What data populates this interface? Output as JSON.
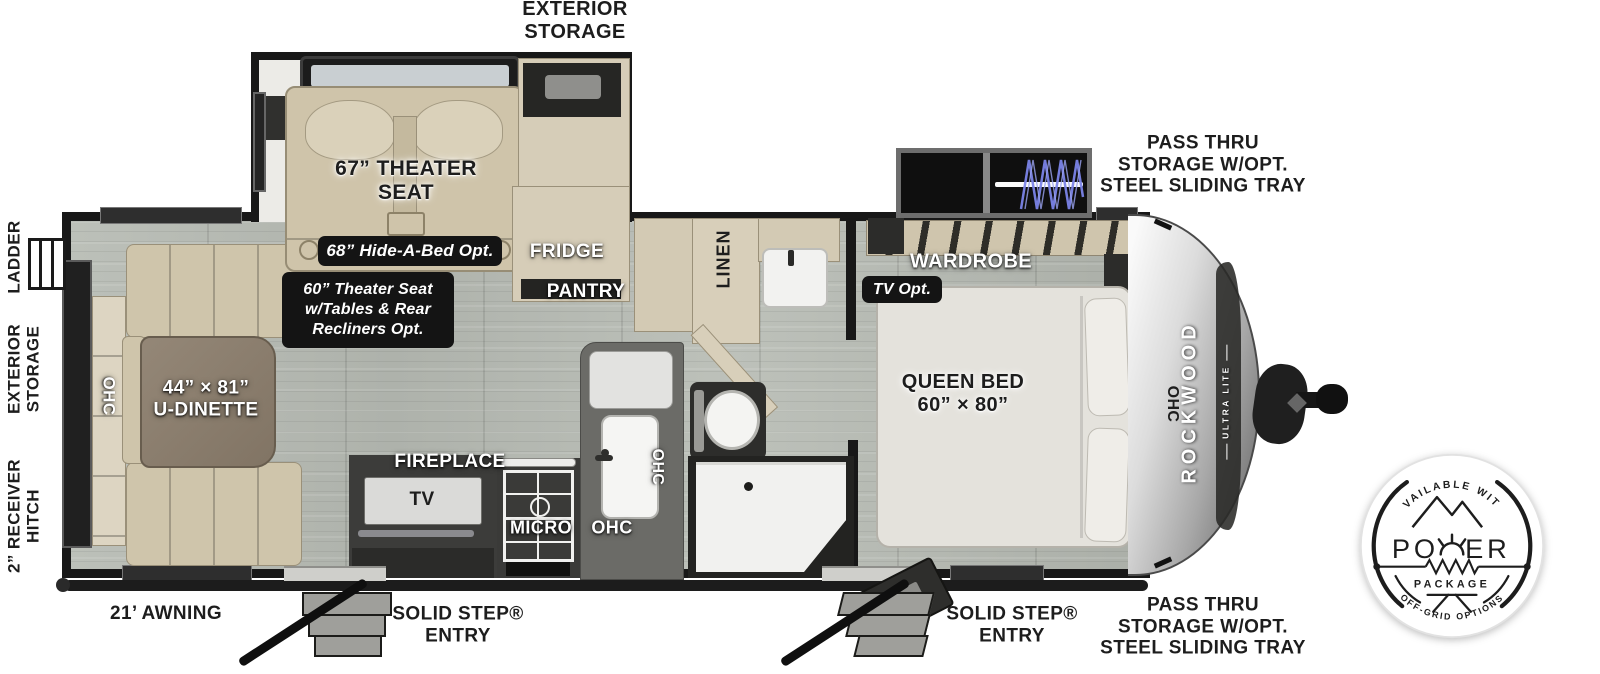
{
  "callouts": {
    "exterior_storage_top": "EXTERIOR\nSTORAGE",
    "pass_thru_storage_top": "PASS THRU\nSTORAGE W/OPT.\nSTEEL SLIDING TRAY",
    "pass_thru_storage_bottom": "PASS THRU\nSTORAGE W/OPT.\nSTEEL SLIDING TRAY",
    "theater_seat": "67” THEATER\nSEAT",
    "hide_a_bed_opt": "68” Hide-A-Bed Opt.",
    "theater_seat_opt": "60” Theater Seat\nw/Tables & Rear\nRecliners Opt.",
    "fridge": "FRIDGE",
    "pantry": "PANTRY",
    "linen": "LINEN",
    "wardrobe": "WARDROBE",
    "tv_opt": "TV Opt.",
    "queen_bed": "QUEEN BED\n60” × 80”",
    "u_dinette": "44” × 81”\nU-DINETTE",
    "ohc": "OHC",
    "fireplace": "FIREPLACE",
    "tv": "TV",
    "micro": "MICRO",
    "awning": "21’ AWNING",
    "solid_step_entry": "SOLID STEP®\nENTRY",
    "ladder": "LADDER",
    "exterior_storage_side": "EXTERIOR\nSTORAGE",
    "receiver_hitch": "2” RECEIVER\nHITCH"
  },
  "brand": {
    "name": "ROCKWOOD",
    "series": "ULTRA LITE"
  },
  "badge": {
    "arc_top": "AVAILABLE WITH",
    "power_pre": "PO",
    "power_post": "ER",
    "package": "PACKAGE",
    "arc_bottom": "OFF-GRID OPTIONS"
  },
  "colors": {
    "wall": "#181818",
    "floor": "#b6bab3",
    "cabinet_tan": "#cfc5ab",
    "table_brown": "#8d8172",
    "counter_gray": "#6b6b67",
    "coil_blue": "#7b84e8",
    "label_ink": "#1d1d1d"
  }
}
